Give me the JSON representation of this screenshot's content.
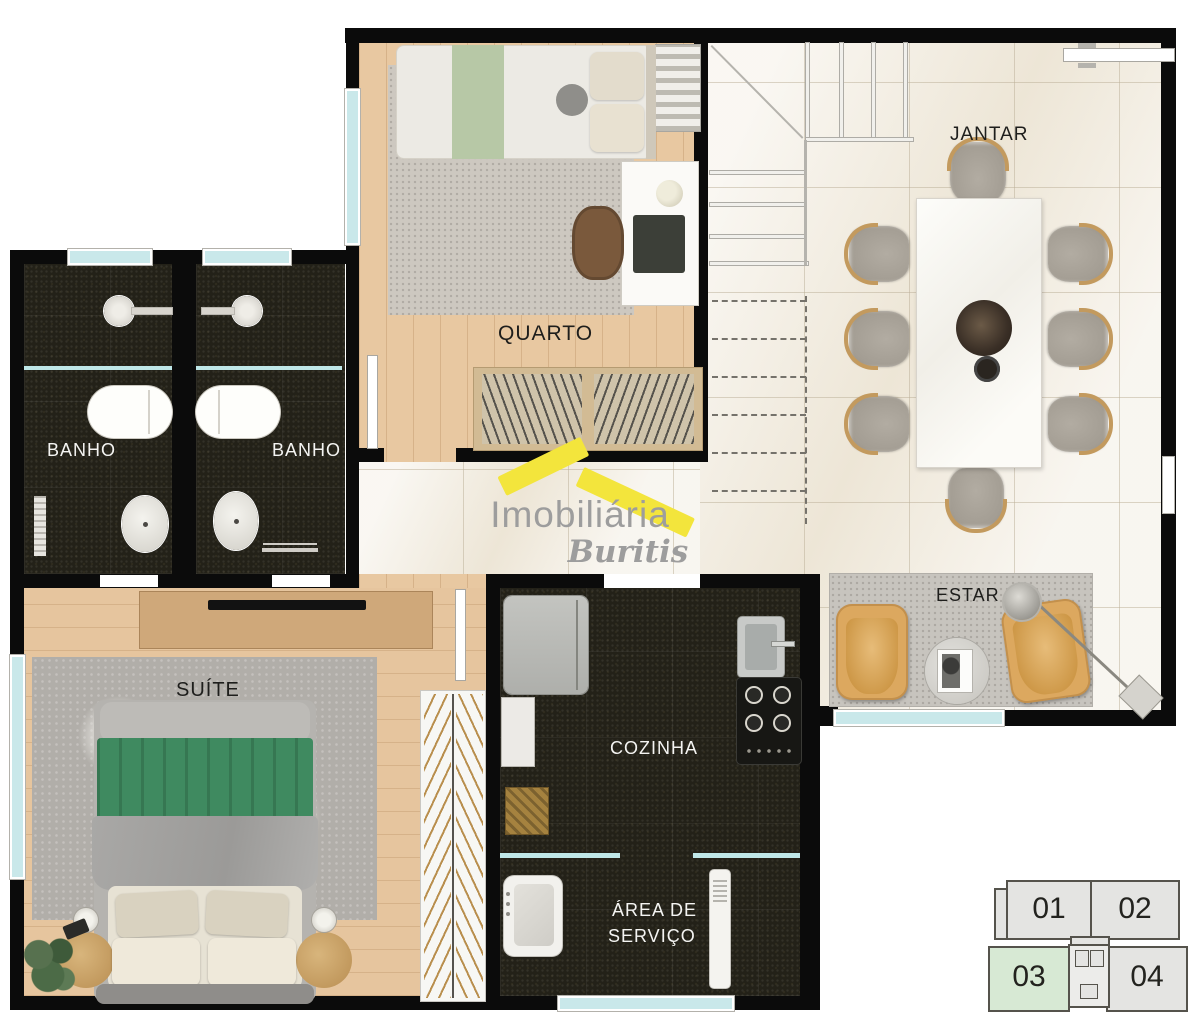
{
  "plan": {
    "rooms": {
      "quarto": {
        "label": "QUARTO"
      },
      "jantar": {
        "label": "JANTAR"
      },
      "banho_esq": {
        "label": "BANHO"
      },
      "banho_dir": {
        "label": "BANHO"
      },
      "suite": {
        "label": "SUÍTE"
      },
      "cozinha": {
        "label": "COZINHA"
      },
      "area_servico": {
        "line1": "ÁREA DE",
        "line2": "SERVIÇO"
      },
      "estar": {
        "label": "ESTAR"
      }
    }
  },
  "logo": {
    "line1": "Imobiliária",
    "line2": "Buritis",
    "roof_color": "#F3E53C",
    "text_color": "#9D9D9D"
  },
  "keyplan": {
    "units": [
      {
        "id": "01",
        "highlighted": false
      },
      {
        "id": "02",
        "highlighted": false
      },
      {
        "id": "03",
        "highlighted": true
      },
      {
        "id": "04",
        "highlighted": false
      }
    ],
    "highlight_color": "#D7E9D4"
  },
  "palette": {
    "wall": "#0B0B0B",
    "window_glass": "#C9E8EA",
    "marble_floor": "#F2ECE0",
    "wood_floor": "#E7C7A0",
    "granite_floor": "#23211A",
    "label_dark": "#1E1E1C",
    "label_light": "#F4F4F2"
  }
}
